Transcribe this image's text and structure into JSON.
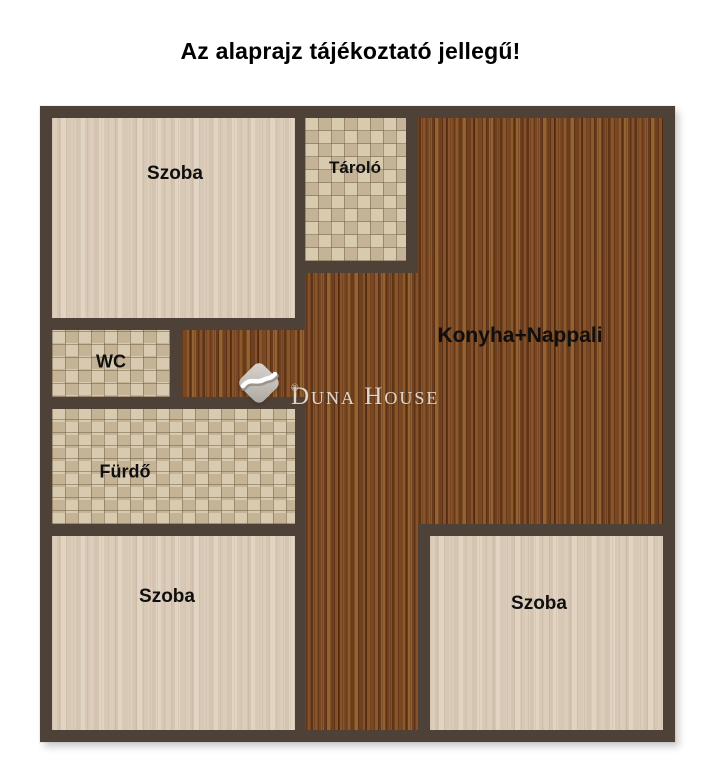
{
  "title": "Az alaprajz tájékoztató jellegű!",
  "rooms": {
    "szoba_top_left": {
      "label": "Szoba"
    },
    "tarolo": {
      "label": "Tároló"
    },
    "konyha_nappali": {
      "label": "Konyha+Nappali"
    },
    "wc": {
      "label": "WC"
    },
    "furdo": {
      "label": "Fürdő"
    },
    "szoba_bottom_left": {
      "label": "Szoba"
    },
    "szoba_bottom_right": {
      "label": "Szoba"
    }
  },
  "watermark": {
    "brand": "Duna House",
    "registered": "®"
  },
  "colors": {
    "wall": "#4e4137",
    "wood_floor": "#7a4722",
    "light_wood_floor": "#dccdbb",
    "tile_floor": "#d3c4a9",
    "title_text": "#000000",
    "label_text": "#0f0f0f",
    "watermark_text": "#ece7df"
  }
}
